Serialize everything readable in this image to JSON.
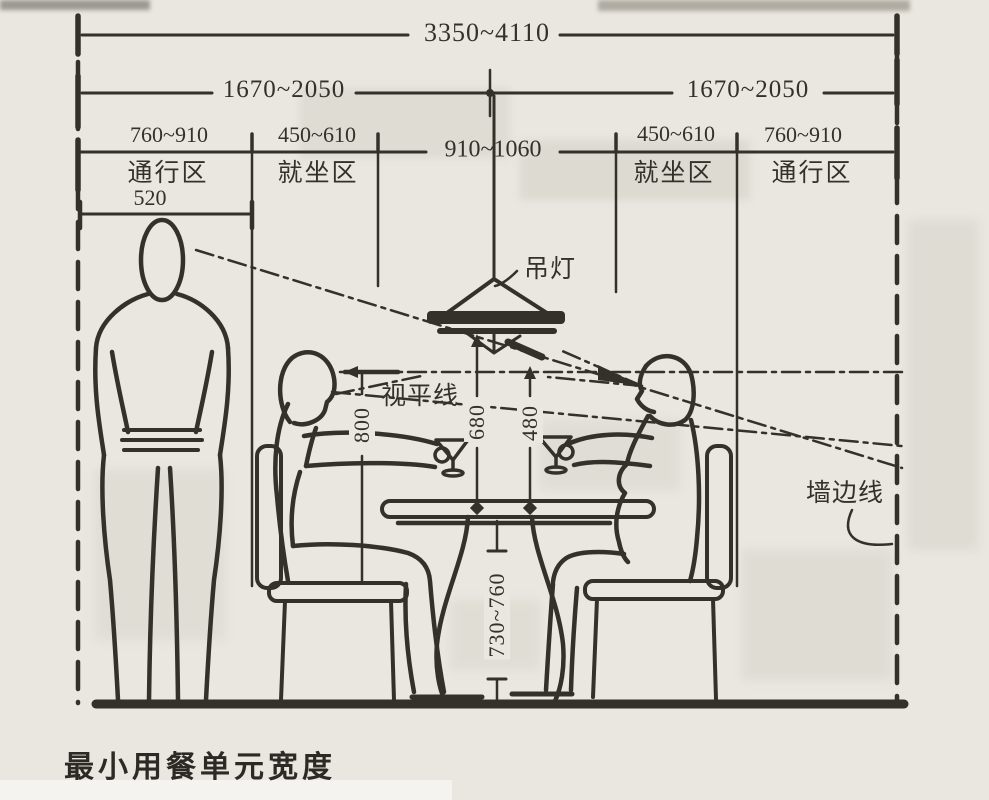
{
  "title_caption": "最小用餐单元宽度",
  "horizontal_dims": {
    "overall": "3350~4110",
    "left_half": "1670~2050",
    "right_half": "1670~2050",
    "left_passage": "760~910",
    "left_seat": "450~610",
    "table": "910~1060",
    "right_seat": "450~610",
    "right_passage": "760~910",
    "standing_person": "520"
  },
  "zones": {
    "left_passage": "通行区",
    "left_seat": "就坐区",
    "right_seat": "就坐区",
    "right_passage": "通行区"
  },
  "vertical_dims": {
    "seat_to_eye": "800",
    "lamp_to_table": "680",
    "eye_to_table": "480",
    "table_height": "730~760"
  },
  "callouts": {
    "pendant_lamp": "吊灯",
    "eye_level_line": "视平线",
    "wall_edge_line": "墙边线"
  },
  "colors": {
    "ink": "#34302a",
    "paper": "#e9e7e0"
  }
}
